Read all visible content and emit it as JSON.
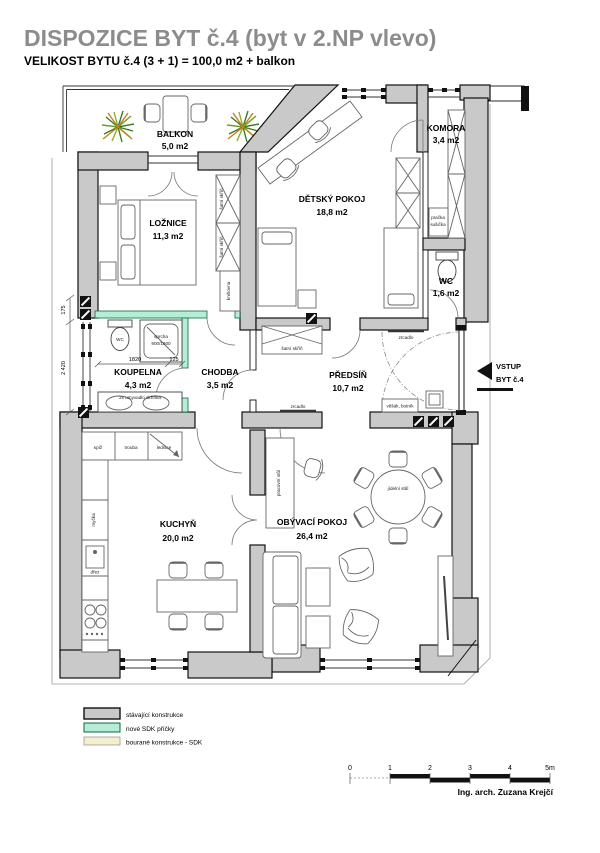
{
  "title": "DISPOZICE BYT č.4 (byt v 2.NP vlevo)",
  "subtitle": "VELIKOST BYTU č.4 (3 + 1) = 100,0 m2 + balkon",
  "rooms": {
    "balkon": {
      "name": "BALKON",
      "area": "5,0 m2"
    },
    "loznice": {
      "name": "LOŽNICE",
      "area": "11,3 m2"
    },
    "detsky": {
      "name": "DĚTSKÝ POKOJ",
      "area": "18,8 m2"
    },
    "komora": {
      "name": "KOMORA",
      "area": "3,4 m2"
    },
    "wc": {
      "name": "WC",
      "area": "1,6 m2"
    },
    "predsin": {
      "name": "PŘEDSÍŇ",
      "area": "10,7 m2"
    },
    "koupelna": {
      "name": "KOUPELNA",
      "area": "4,3 m2"
    },
    "chodba": {
      "name": "CHODBA",
      "area": "3,5 m2"
    },
    "kuchyn": {
      "name": "KUCHYŇ",
      "area": "20,0 m2"
    },
    "obyvak": {
      "name": "OBÝVACÍ POKOJ",
      "area": "26,4 m2"
    }
  },
  "labels": {
    "satni_skrin": "šatní skříň",
    "knihovna": "knihovna",
    "pracka": "pračka",
    "susicka": "sušička",
    "wc_small": "WC",
    "sprcha": "sprcha",
    "sprcha_rozmer": "900/1900",
    "umyvadlo": "2x umyvadlo skříňka",
    "spiz": "spíž",
    "trouba": "trouba",
    "lednice": "lednice",
    "mycka": "myčka",
    "drez": "dřez",
    "zrcadlo": "zrcadlo",
    "vesak_botnik": "věšák, botník",
    "pracovni_stul": "pracovní stůl",
    "jidelni_stul": "jídelní stůl"
  },
  "entrance": {
    "line1": "VSTUP",
    "line2": "BYT č.4"
  },
  "dims": {
    "d175": "175",
    "d2420": "2 420",
    "d1820": "1820",
    "d125": "125"
  },
  "legend": [
    {
      "label": "stávající konstrukce",
      "color": "#c9c9c9"
    },
    {
      "label": "nové SDK příčky",
      "color": "#b7ecd6"
    },
    {
      "label": "bourané konstrukce - SDK",
      "color": "#f6efcd"
    }
  ],
  "scalebar": {
    "ticks": [
      "0",
      "1",
      "2",
      "3",
      "4",
      "5m"
    ]
  },
  "credit": "Ing. arch. Zuzana Krejčí",
  "colors": {
    "wall": "#c9c9c9",
    "new_partition": "#b7ecd6",
    "demolished": "#f6efcd",
    "title": "#8c8c8c"
  }
}
